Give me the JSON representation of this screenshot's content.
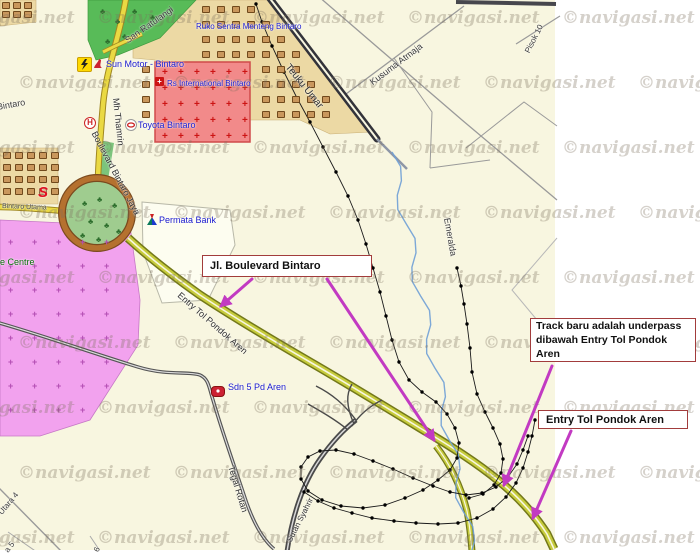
{
  "watermark_text": "©navigasi.net",
  "callouts": {
    "c1": "Jl. Boulevard Bintaro",
    "c2_line1": "Track baru adalah underpass",
    "c2_line2": "dibawah Entry Tol Pondok Aren",
    "c3": "Entry Tol Pondok Aren"
  },
  "road_labels": {
    "san_ratulangi": "San Ratulangi",
    "pisok": "Pisok 10",
    "teuku_umar": "Teuku Umar",
    "kusuma_atmaja": "Kusuma Atmaja",
    "mh_thamrin": "Mh Thamrin",
    "bintaro": "Bintaro",
    "boulevard_bintaro_jaya": "Boulevard Bintaro Jaya",
    "bintaro_utama": "Bintaro Utama",
    "entry_tol": "Entry Tol Pondok Aren",
    "emeralda": "Emeralda",
    "tegal_rotan": "Tegal Rotan",
    "sutan_syahrir": "Sutan Syahrir",
    "utara4": "Utara 4",
    "a5": "a 5",
    "six": "6"
  },
  "poi_labels": {
    "ruko": "Ruko Sentra Menteng Bintaro",
    "sun_motor": "Sun Motor - Bintaro",
    "rs_international": "Rs International Bintaro",
    "toyota": "Toyota Bintaro",
    "permata": "Permata Bank",
    "e_centre": "e Centre",
    "sdn5": "Sdn 5 Pd Aren"
  },
  "icon_glyphs": {
    "honda": "H",
    "suzuki": "S",
    "hospital_cross": "+",
    "grave": "+",
    "tree": "♣"
  },
  "colors": {
    "map_bg": "#f8f6e0",
    "toll_road": "#c6cb3c",
    "local_road": "#ead943",
    "arrow_accent": "#c23ac2",
    "callout_border": "#a23c3c",
    "river": "#6fa0d6",
    "poi_text": "#1a1acc"
  }
}
